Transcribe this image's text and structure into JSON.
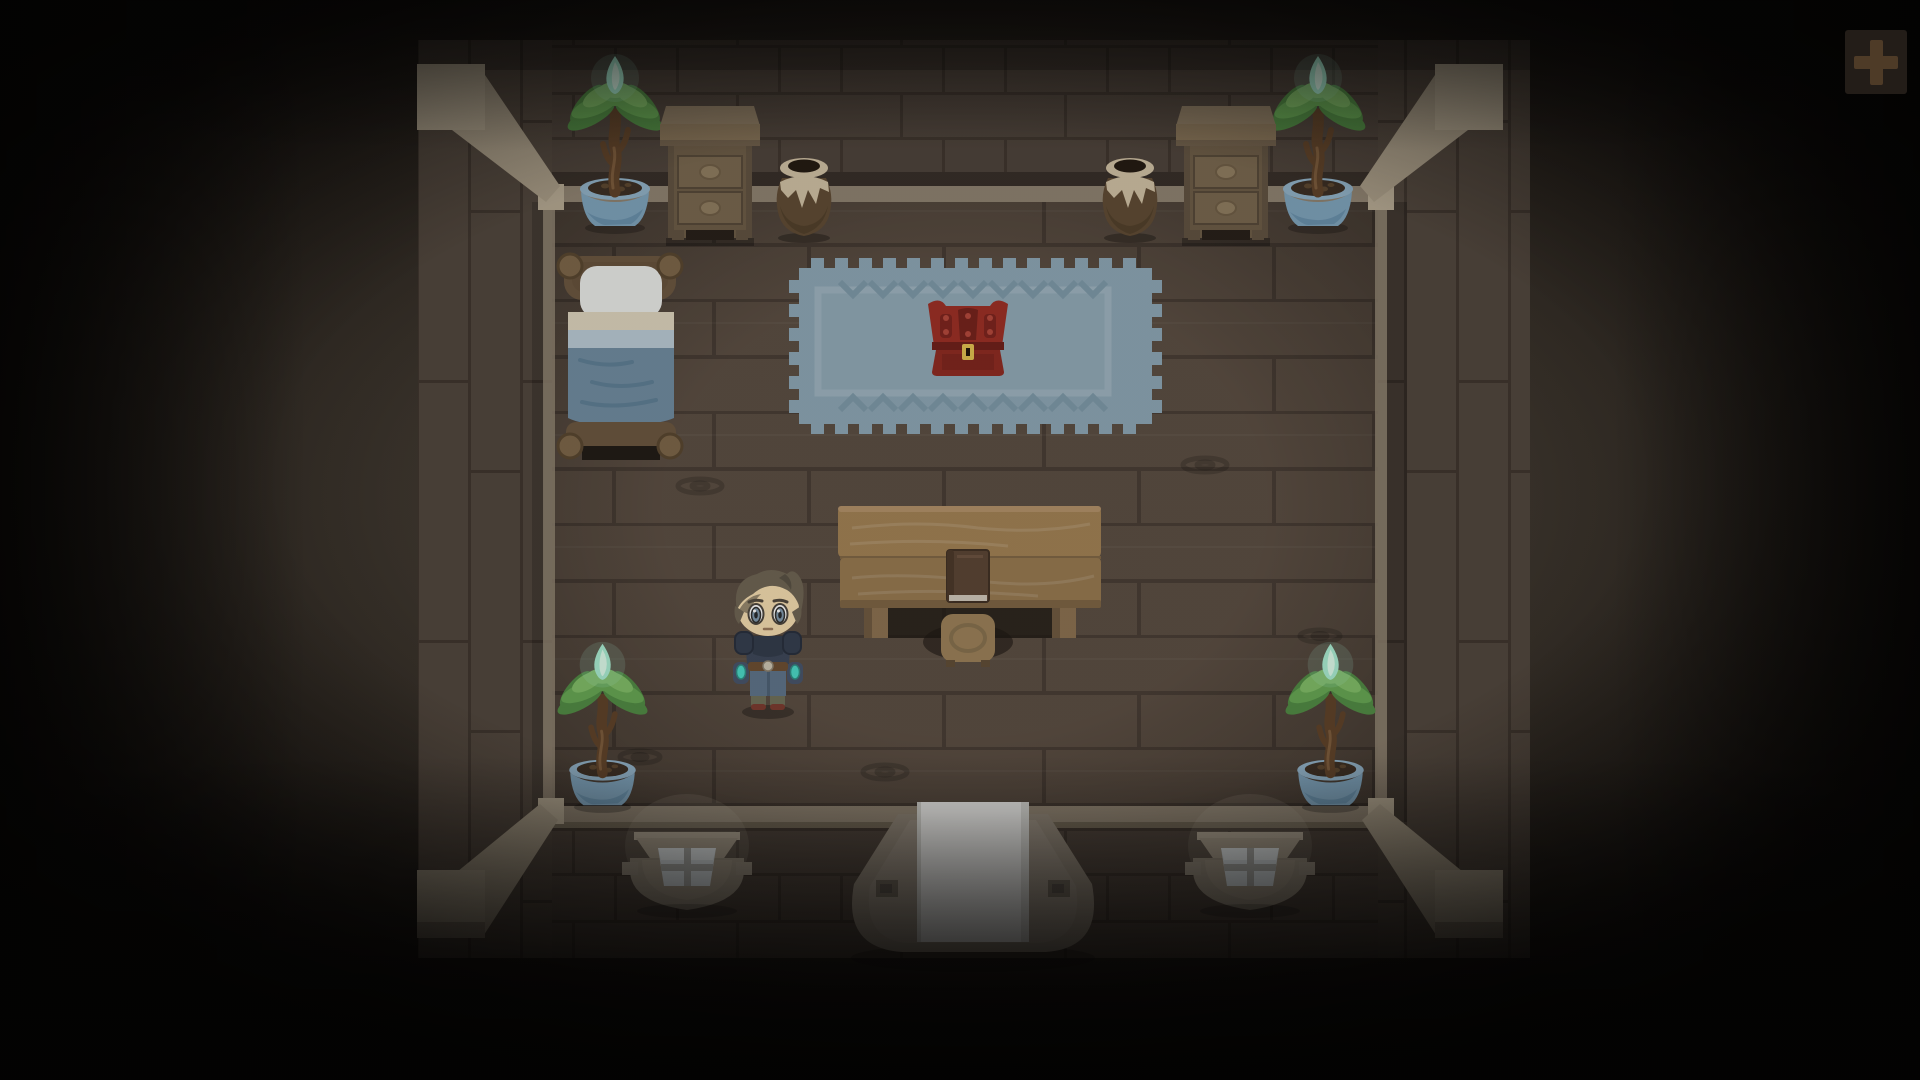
{
  "meta": {
    "screen": "top-down-room",
    "width": 1920,
    "height": 1080
  },
  "hud": {
    "zoom_in_button": {
      "icon": "plus-icon"
    }
  },
  "scene": {
    "room": {
      "kind": "wooden cabin interior",
      "view": "top-down"
    },
    "objects": [
      {
        "id": "plant-top-left",
        "kind": "potted plant with glowing sprout"
      },
      {
        "id": "plant-top-right",
        "kind": "potted plant with glowing sprout"
      },
      {
        "id": "plant-bottom-left",
        "kind": "potted plant with glowing sprout"
      },
      {
        "id": "plant-bottom-right",
        "kind": "potted plant with glowing sprout"
      },
      {
        "id": "dresser-left",
        "kind": "two-drawer dresser"
      },
      {
        "id": "dresser-right",
        "kind": "two-drawer dresser"
      },
      {
        "id": "clay-pot-left",
        "kind": "glazed clay pot"
      },
      {
        "id": "clay-pot-right",
        "kind": "glazed clay pot"
      },
      {
        "id": "bed",
        "kind": "single bed with blue blanket"
      },
      {
        "id": "rug",
        "kind": "blue fringed rug with chevron pattern"
      },
      {
        "id": "chest",
        "kind": "red treasure chest with gold latch"
      },
      {
        "id": "table",
        "kind": "wooden plank table"
      },
      {
        "id": "book",
        "kind": "closed book on table"
      },
      {
        "id": "stool",
        "kind": "wooden stool"
      },
      {
        "id": "player",
        "kind": "boy character with gray hair and blue armor"
      },
      {
        "id": "window-left",
        "kind": "four-pane window"
      },
      {
        "id": "window-right",
        "kind": "four-pane window"
      },
      {
        "id": "door",
        "kind": "white front door with porch"
      }
    ]
  },
  "palette": {
    "wall-brick": "#4c423a",
    "wall-seam": "#3d342d",
    "floor": "#5a4d42",
    "floor-seam": "#473c34",
    "trim": "#8d8170",
    "trim-dark": "#6f6554",
    "beam": "#a79b86",
    "beam-light": "#b3a791",
    "beam-dark": "#8d8170",
    "rug": "#8ca6b5",
    "rug-dark": "#7d99a9",
    "rug-light": "#9db3c0",
    "bed-frame": "#6a563f",
    "bed-post": "#7b6548",
    "pillow": "#e9eae8",
    "sheet-cream": "#ddd4be",
    "sheet-blue": "#b9cad5",
    "blanket": "#6f8ba0",
    "blanket-fold": "#5d7e95",
    "chest-red": "#9c2e24",
    "chest-dark": "#74211b",
    "chest-latch": "#e3c050",
    "wood-table": "#a18154",
    "wood-table2": "#96784f",
    "wood-leg": "#8a7050",
    "book-cover": "#5a4434",
    "book-pages": "#cfc8bb",
    "pot-blue": "#7da2bb",
    "pot-blue-light": "#8fb0c6",
    "pot-blue-dark": "#6890ab",
    "soil": "#3a2d22",
    "trunk": "#5d4128",
    "trunk-light": "#7a5a3b",
    "leaf-dark": "#4f8a43",
    "leaf-mid": "#65a653",
    "leaf-light": "#7fbc66",
    "crystal": "#a8ecd2",
    "crystal-light": "#dcfbea",
    "jar-brown": "#5e4a33",
    "jar-dark": "#463723",
    "glaze": "#cfc0a4",
    "dresser-top": "#857257",
    "dresser-body": "#6b5b46",
    "drawer": "#77664e",
    "drawer-line": "#554838",
    "handle": "#8e7c60",
    "hair": "#6d6453",
    "hair-dark": "#575043",
    "skin": "#f4dcb0",
    "iris": "#7f98ac",
    "armor": "#3c4658",
    "armor-dark": "#313b4b",
    "pants": "#5d7389",
    "belt": "#6b4d31",
    "gem": "#4ad9c8",
    "boot": "#6e6f58",
    "boot-sole": "#7a3a2e",
    "window-frame": "#968c7c",
    "pane": "#d6dde0",
    "pane-bar": "#a9aaa6",
    "door-porch": "#8f8577",
    "door-white": "#ececea",
    "plus-bg": "#231d18",
    "plus-glyph": "#4e3b27"
  }
}
